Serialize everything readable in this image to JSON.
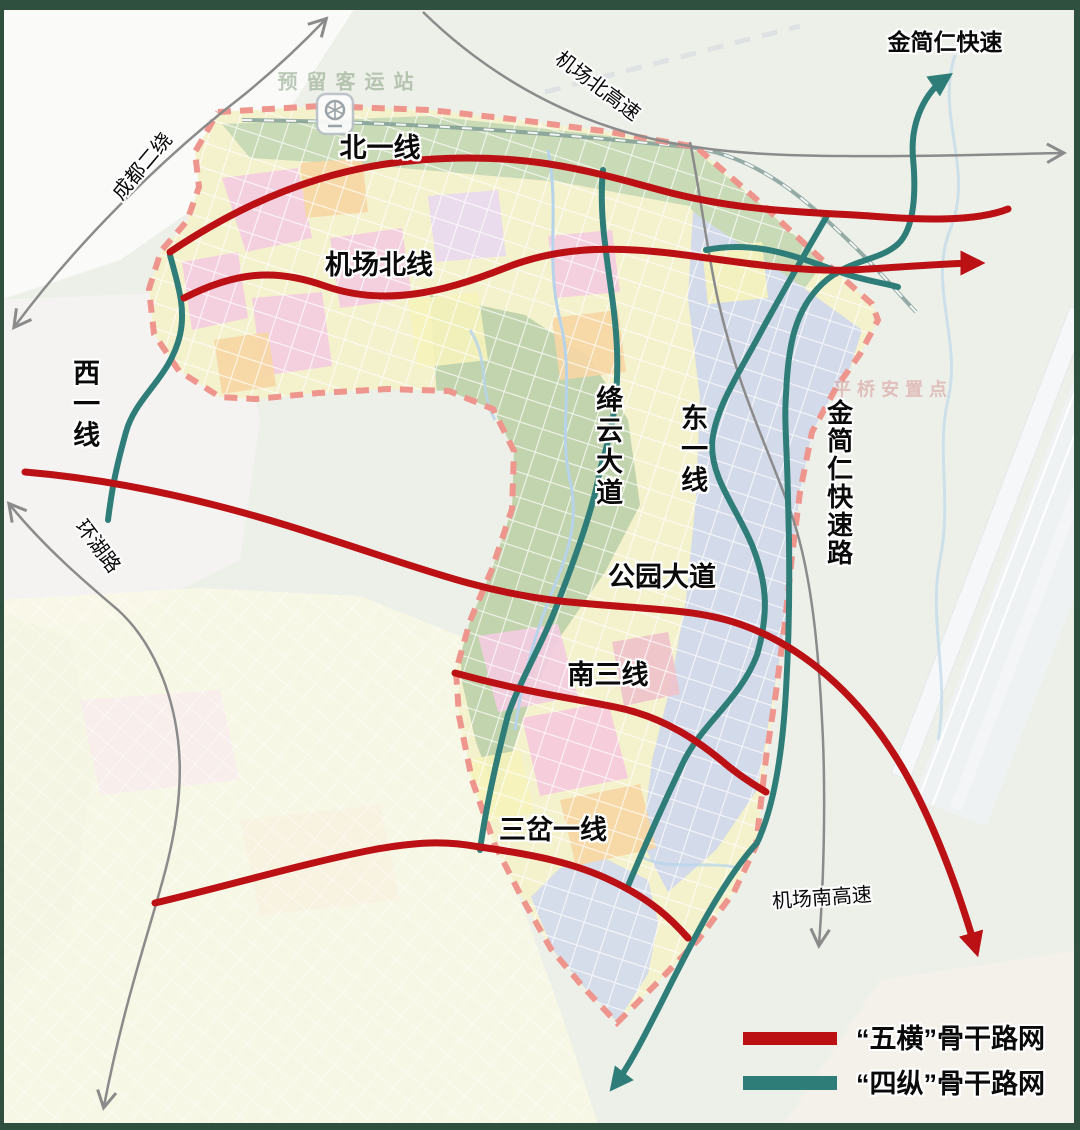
{
  "map": {
    "type": "urban-road-network-planning-map",
    "colors": {
      "red_route": "#bb1014",
      "teal_route": "#2e7d78",
      "gray_road": "#8b8b8b",
      "boundary_dash": "#ee958d",
      "railway": "#7e9b95"
    },
    "road_labels": {
      "north_line1": "北一线",
      "airport_north_line": "机场北线",
      "park_avenue": "公园大道",
      "south_line3": "南三线",
      "sancha_line1": "三岔一线",
      "west_line1": "西一线",
      "jiangyun_avenue": "绛云大道",
      "east_line1": "东一线",
      "jinjianren_expressway_road": "金简仁快速路",
      "jinjianren_expressway": "金简仁快速",
      "chengdu_second_ring": "成都二绕",
      "airport_north_expressway": "机场北高速",
      "ringlake_road": "环湖路",
      "airport_south_expressway": "机场南高速"
    },
    "faint_labels": {
      "reserved_station": "预留客运站",
      "pingqiao_settlement": "平桥安置点"
    },
    "legend": {
      "items": [
        {
          "label": "“五横”骨干路网",
          "color": "#bb1014"
        },
        {
          "label": "“四纵”骨干路网",
          "color": "#2e7d78"
        }
      ]
    }
  }
}
